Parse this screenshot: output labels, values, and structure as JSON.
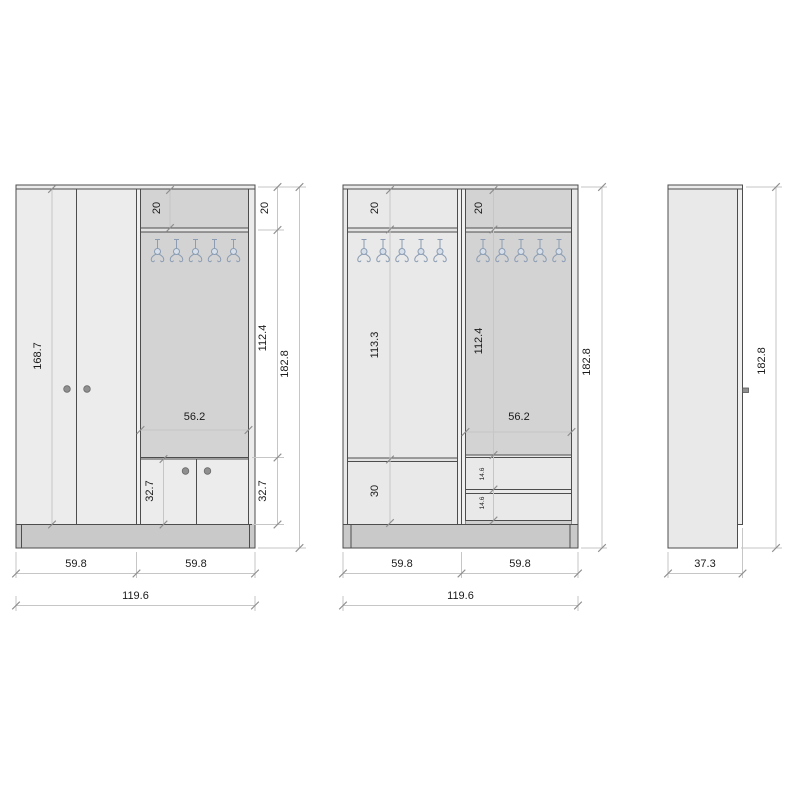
{
  "drawing": {
    "background": "#ffffff",
    "views": {
      "front_exterior": {
        "dims": {
          "door_height": "168.7",
          "top_compartment_inner": "20",
          "top_compartment": "20",
          "hook_area_height": "112.4",
          "open_section_width": "56.2",
          "lower_doors_inner": "32.7",
          "lower_doors": "32.7",
          "total_height": "182.8",
          "left_width": "59.8",
          "right_width": "59.8",
          "total_width": "119.6"
        }
      },
      "front_interior": {
        "dims": {
          "top_compartment_left": "20",
          "top_compartment_right": "20",
          "open_left_height": "113.3",
          "open_right_height": "112.4",
          "open_right_width": "56.2",
          "lower_compartment": "30",
          "drawer_top": "14.6",
          "drawer_bottom": "14.6",
          "total_height": "182.8",
          "left_width": "59.8",
          "right_width": "59.8",
          "total_width": "119.6"
        }
      },
      "side": {
        "dims": {
          "total_height": "182.8",
          "depth": "37.3"
        }
      }
    },
    "coat_hooks": {
      "sections": 3,
      "hooks_per_section": 5
    },
    "icons": {
      "coat_hook": "double-prong-coat-hook",
      "door_handle": "round-knob"
    },
    "colors": {
      "panel_light": "#ececec",
      "panel_open": "#d3d3d3",
      "panel_interior_light": "#e9e9e9",
      "shelf_band": "#e2e2e2",
      "plinth": "#c9c9c9",
      "outline": "#4d4d4d",
      "dimension_line": "#c6c6c6",
      "tick": "#8f8f8f",
      "dimension_text": "#1a1a1a",
      "hook_stroke": "#8b9cb3",
      "hook_fill": "#d7e0ea",
      "handle": "#8f8f8f"
    }
  }
}
